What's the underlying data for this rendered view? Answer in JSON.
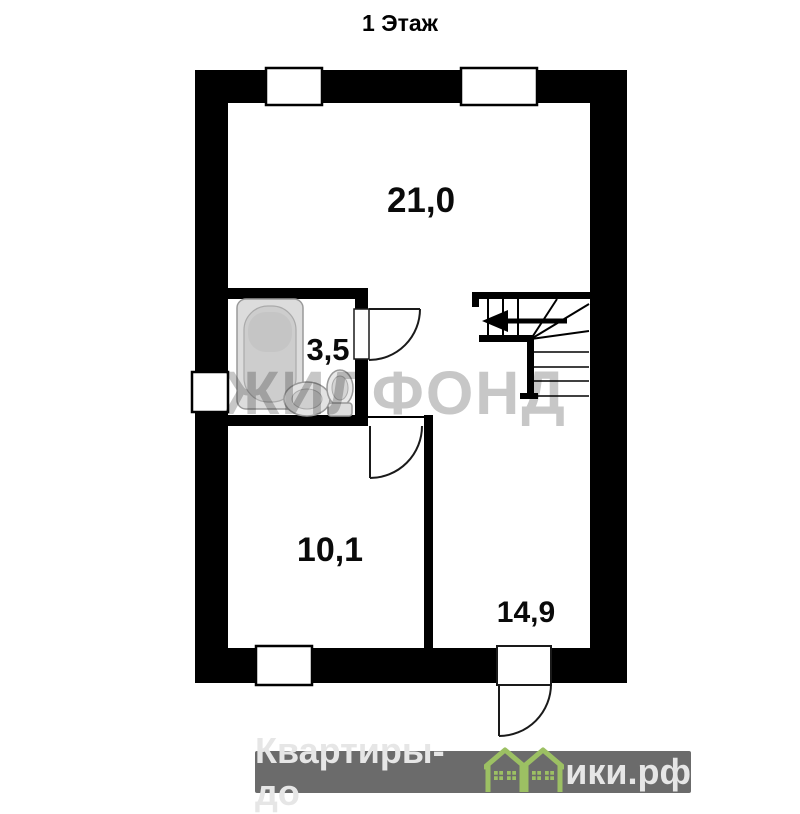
{
  "title": "1 Этаж",
  "floor_plan": {
    "watermark": "ЖИЛФОНД",
    "rooms": [
      {
        "name": "living-room",
        "area_label": "21,0"
      },
      {
        "name": "bathroom",
        "area_label": "3,5"
      },
      {
        "name": "bedroom",
        "area_label": "10,1"
      },
      {
        "name": "hall",
        "area_label": "14,9"
      }
    ],
    "fixtures": [
      "bathtub-icon",
      "sink-icon",
      "toilet-icon"
    ],
    "stairs": {
      "direction_arrow": "left"
    },
    "windows_count": 4,
    "doors_count": 3,
    "colors": {
      "walls": "#000000",
      "fixtures": "#dcdcdc",
      "watermark": "#c7c7c7"
    }
  },
  "footer": {
    "brand_before": "Квартиры-до",
    "brand_after": "ики.рф",
    "icon": "green-houses-icon",
    "colors": {
      "band": "#6b6b6b",
      "text": "#e6e6e6",
      "houses": "#9cc063"
    }
  }
}
